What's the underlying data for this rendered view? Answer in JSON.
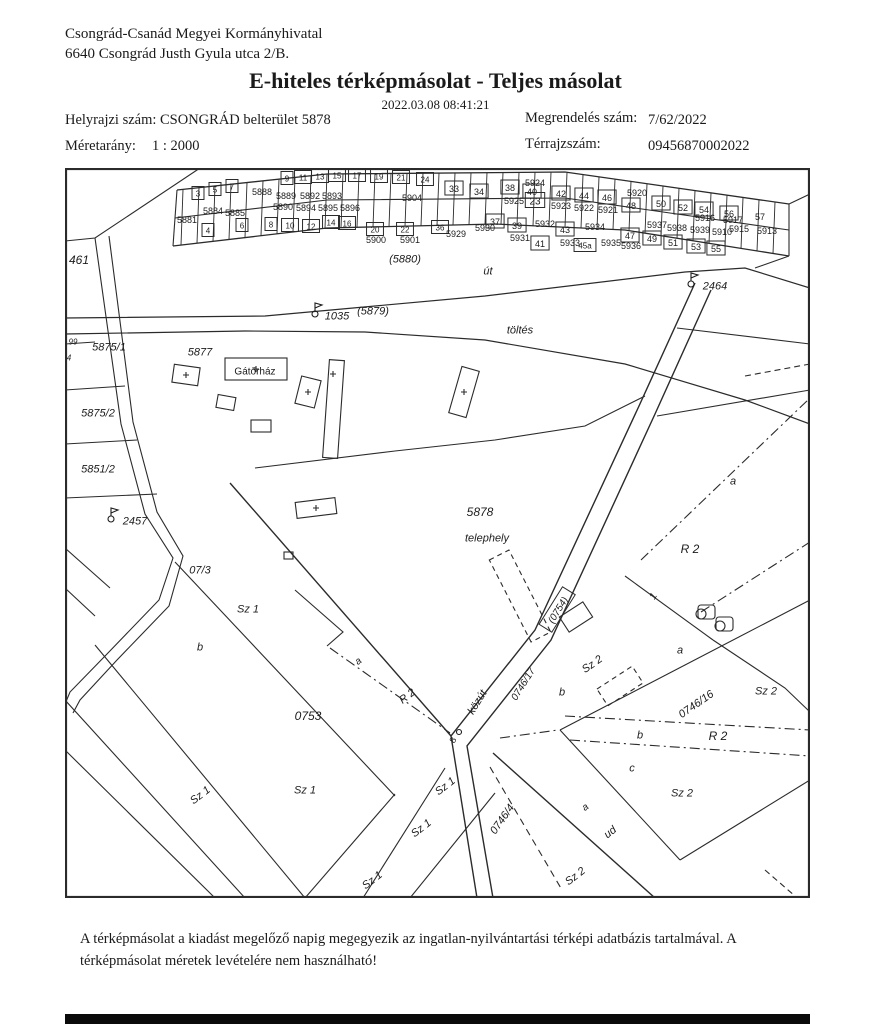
{
  "header": {
    "office_name": "Csongrád-Csanád Megyei Kormányhivatal",
    "office_address": "6640 Csongrád Justh Gyula utca 2/B.",
    "title": "E-hiteles térképmásolat - Teljes másolat",
    "timestamp": "2022.03.08 08:41:21",
    "fields": {
      "helyrajzi_label": "Helyrajzi szám:",
      "helyrajzi_value": "CSONGRÁD belterület 5878",
      "megrendeles_label": "Megrendelés szám:",
      "megrendeles_value": "7/62/2022",
      "meretarany_label": "Méretarány:",
      "meretarany_value": "1 : 2000",
      "terrajz_label": "Térrajzszám:",
      "terrajz_value": "09456870002022"
    }
  },
  "footer": {
    "disclaimer": "A térképmásolat a kiadást megelőző napig megegyezik az ingatlan-nyilvántartási térképi adatbázis tartalmával. A térképmásolat méretek levételére nem használható!"
  },
  "map": {
    "labels": [
      {
        "t": "461",
        "x": 14,
        "y": 92,
        "r": 0,
        "s": 12,
        "k": "i"
      },
      {
        "t": "(5880)",
        "x": 340,
        "y": 91,
        "r": 0,
        "s": 11,
        "k": "i"
      },
      {
        "t": "út",
        "x": 423,
        "y": 103,
        "r": 0,
        "s": 11,
        "k": "i"
      },
      {
        "t": "1035",
        "x": 272,
        "y": 148,
        "r": 0,
        "s": 11,
        "k": "i"
      },
      {
        "t": "(5879)",
        "x": 308,
        "y": 143,
        "r": 0,
        "s": 11,
        "k": "i"
      },
      {
        "t": "töltés",
        "x": 455,
        "y": 162,
        "r": 0,
        "s": 11,
        "k": "i"
      },
      {
        "t": "2464",
        "x": 650,
        "y": 118,
        "r": 0,
        "s": 11,
        "k": "i"
      },
      {
        "t": "99",
        "x": 8,
        "y": 174,
        "r": 0,
        "s": 8,
        "k": "i"
      },
      {
        "t": "5875/1",
        "x": 44,
        "y": 179,
        "r": 0,
        "s": 11,
        "k": "i"
      },
      {
        "t": "4",
        "x": 4,
        "y": 190,
        "r": 0,
        "s": 8,
        "k": "i"
      },
      {
        "t": "5877",
        "x": 135,
        "y": 184,
        "r": 0,
        "s": 11,
        "k": "i"
      },
      {
        "t": "Gátőrház",
        "x": 190,
        "y": 203,
        "r": 0,
        "s": 10,
        "k": "n"
      },
      {
        "t": "5875/2",
        "x": 33,
        "y": 245,
        "r": 0,
        "s": 11,
        "k": "i"
      },
      {
        "t": "5851/2",
        "x": 33,
        "y": 301,
        "r": 0,
        "s": 11,
        "k": "i"
      },
      {
        "t": "2457",
        "x": 70,
        "y": 353,
        "r": 0,
        "s": 11,
        "k": "i"
      },
      {
        "t": "07/3",
        "x": 135,
        "y": 402,
        "r": 0,
        "s": 11,
        "k": "i"
      },
      {
        "t": "Sz 1",
        "x": 183,
        "y": 441,
        "r": 0,
        "s": 11,
        "k": "i"
      },
      {
        "t": "b",
        "x": 135,
        "y": 479,
        "r": 0,
        "s": 11,
        "k": "i"
      },
      {
        "t": "0753",
        "x": 243,
        "y": 548,
        "r": 0,
        "s": 12,
        "k": "i"
      },
      {
        "t": "Sz 1",
        "x": 240,
        "y": 622,
        "r": 0,
        "s": 11,
        "k": "i"
      },
      {
        "t": "Sz 1",
        "x": 135,
        "y": 627,
        "r": -38,
        "s": 11,
        "k": "i"
      },
      {
        "t": "a",
        "x": 293,
        "y": 493,
        "r": -38,
        "s": 10,
        "k": "i"
      },
      {
        "t": "R 2",
        "x": 342,
        "y": 528,
        "r": -38,
        "s": 11,
        "k": "i"
      },
      {
        "t": "közút",
        "x": 412,
        "y": 534,
        "r": -58,
        "s": 11,
        "k": "i"
      },
      {
        "t": "8",
        "x": 388,
        "y": 572,
        "r": -58,
        "s": 9,
        "k": "n"
      },
      {
        "t": "(0754)",
        "x": 493,
        "y": 442,
        "r": -58,
        "s": 10,
        "k": "bi"
      },
      {
        "t": "0746/17",
        "x": 458,
        "y": 516,
        "r": -58,
        "s": 10,
        "k": "i"
      },
      {
        "t": "5878",
        "x": 415,
        "y": 344,
        "r": 0,
        "s": 12,
        "k": "i"
      },
      {
        "t": "telephely",
        "x": 422,
        "y": 370,
        "r": 0,
        "s": 11,
        "k": "i"
      },
      {
        "t": "R 2",
        "x": 625,
        "y": 381,
        "r": 0,
        "s": 12,
        "k": "i"
      },
      {
        "t": "a",
        "x": 668,
        "y": 313,
        "r": 0,
        "s": 11,
        "k": "i"
      },
      {
        "t": "1",
        "x": 588,
        "y": 428,
        "r": -58,
        "s": 10,
        "k": "i"
      },
      {
        "t": "Sz 2",
        "x": 527,
        "y": 496,
        "r": -35,
        "s": 11,
        "k": "i"
      },
      {
        "t": "b",
        "x": 497,
        "y": 524,
        "r": 0,
        "s": 11,
        "k": "i"
      },
      {
        "t": "a",
        "x": 615,
        "y": 482,
        "r": 0,
        "s": 11,
        "k": "i"
      },
      {
        "t": "0746/16",
        "x": 631,
        "y": 536,
        "r": -35,
        "s": 11,
        "k": "i"
      },
      {
        "t": "Sz 2",
        "x": 701,
        "y": 523,
        "r": 0,
        "s": 11,
        "k": "i"
      },
      {
        "t": "b",
        "x": 575,
        "y": 567,
        "r": 0,
        "s": 11,
        "k": "i"
      },
      {
        "t": "R 2",
        "x": 653,
        "y": 568,
        "r": 0,
        "s": 12,
        "k": "i"
      },
      {
        "t": "c",
        "x": 567,
        "y": 600,
        "r": 0,
        "s": 11,
        "k": "i"
      },
      {
        "t": "Sz 2",
        "x": 617,
        "y": 625,
        "r": 0,
        "s": 11,
        "k": "i"
      },
      {
        "t": "a",
        "x": 520,
        "y": 639,
        "r": -38,
        "s": 10,
        "k": "i"
      },
      {
        "t": "ud",
        "x": 545,
        "y": 664,
        "r": -38,
        "s": 11,
        "k": "i"
      },
      {
        "t": "Sz 1",
        "x": 380,
        "y": 618,
        "r": -38,
        "s": 11,
        "k": "i"
      },
      {
        "t": "Sz 1",
        "x": 356,
        "y": 660,
        "r": -38,
        "s": 11,
        "k": "i"
      },
      {
        "t": "Sz 1",
        "x": 307,
        "y": 712,
        "r": -38,
        "s": 11,
        "k": "i"
      },
      {
        "t": "0746/4",
        "x": 437,
        "y": 651,
        "r": -55,
        "s": 11,
        "k": "i"
      },
      {
        "t": "Sz 2",
        "x": 510,
        "y": 708,
        "r": -38,
        "s": 11,
        "k": "i"
      },
      {
        "t": "5888",
        "x": 197,
        "y": 24,
        "r": 0,
        "s": 9,
        "k": "n"
      },
      {
        "t": "5889",
        "x": 221,
        "y": 28,
        "r": 0,
        "s": 9,
        "k": "n"
      },
      {
        "t": "5892",
        "x": 245,
        "y": 28,
        "r": 0,
        "s": 9,
        "k": "n"
      },
      {
        "t": "5893",
        "x": 267,
        "y": 28,
        "r": 0,
        "s": 9,
        "k": "n"
      },
      {
        "t": "5904",
        "x": 347,
        "y": 30,
        "r": 0,
        "s": 9,
        "k": "n"
      },
      {
        "t": "5890",
        "x": 218,
        "y": 39,
        "r": 0,
        "s": 9,
        "k": "n"
      },
      {
        "t": "5894",
        "x": 241,
        "y": 40,
        "r": 0,
        "s": 9,
        "k": "n"
      },
      {
        "t": "5895",
        "x": 263,
        "y": 40,
        "r": 0,
        "s": 9,
        "k": "n"
      },
      {
        "t": "5896",
        "x": 285,
        "y": 40,
        "r": 0,
        "s": 9,
        "k": "n"
      },
      {
        "t": "3",
        "x": 133,
        "y": 26,
        "r": 0,
        "s": 8,
        "k": "b"
      },
      {
        "t": "5",
        "x": 150,
        "y": 22,
        "r": 0,
        "s": 8,
        "k": "b"
      },
      {
        "t": "7",
        "x": 167,
        "y": 19,
        "r": 0,
        "s": 8,
        "k": "b"
      },
      {
        "t": "9",
        "x": 222,
        "y": 11,
        "r": 0,
        "s": 8,
        "k": "b"
      },
      {
        "t": "11",
        "x": 238,
        "y": 10,
        "r": 0,
        "s": 8,
        "k": "b"
      },
      {
        "t": "13",
        "x": 255,
        "y": 9,
        "r": 0,
        "s": 8,
        "k": "b"
      },
      {
        "t": "15",
        "x": 272,
        "y": 8,
        "r": 0,
        "s": 8,
        "k": "b"
      },
      {
        "t": "17",
        "x": 292,
        "y": 8,
        "r": 0,
        "s": 8,
        "k": "b"
      },
      {
        "t": "19",
        "x": 314,
        "y": 9,
        "r": 0,
        "s": 8,
        "k": "b"
      },
      {
        "t": "21",
        "x": 336,
        "y": 10,
        "r": 0,
        "s": 8,
        "k": "b"
      },
      {
        "t": "24",
        "x": 360,
        "y": 12,
        "r": 0,
        "s": 8,
        "k": "b"
      },
      {
        "t": "23",
        "x": 470,
        "y": 33,
        "r": 0,
        "s": 10,
        "k": "b"
      },
      {
        "t": "33",
        "x": 389,
        "y": 21,
        "r": 0,
        "s": 9,
        "k": "b"
      },
      {
        "t": "34",
        "x": 414,
        "y": 24,
        "r": 0,
        "s": 9,
        "k": "b"
      },
      {
        "t": "38",
        "x": 445,
        "y": 20,
        "r": 0,
        "s": 9,
        "k": "b"
      },
      {
        "t": "5925",
        "x": 449,
        "y": 33,
        "r": 0,
        "s": 9,
        "k": "n"
      },
      {
        "t": "5924",
        "x": 470,
        "y": 15,
        "r": 0,
        "s": 9,
        "k": "n"
      },
      {
        "t": "40",
        "x": 467,
        "y": 24,
        "r": 0,
        "s": 9,
        "k": "b"
      },
      {
        "t": "42",
        "x": 496,
        "y": 26,
        "r": 0,
        "s": 9,
        "k": "b"
      },
      {
        "t": "5923",
        "x": 496,
        "y": 38,
        "r": 0,
        "s": 9,
        "k": "n"
      },
      {
        "t": "44",
        "x": 519,
        "y": 28,
        "r": 0,
        "s": 9,
        "k": "b"
      },
      {
        "t": "5922",
        "x": 519,
        "y": 40,
        "r": 0,
        "s": 9,
        "k": "n"
      },
      {
        "t": "46",
        "x": 542,
        "y": 30,
        "r": 0,
        "s": 9,
        "k": "b"
      },
      {
        "t": "5921",
        "x": 543,
        "y": 42,
        "r": 0,
        "s": 9,
        "k": "n"
      },
      {
        "t": "5920",
        "x": 572,
        "y": 25,
        "r": 0,
        "s": 9,
        "k": "n"
      },
      {
        "t": "48",
        "x": 566,
        "y": 38,
        "r": 0,
        "s": 9,
        "k": "b"
      },
      {
        "t": "50",
        "x": 596,
        "y": 36,
        "r": 0,
        "s": 9,
        "k": "b"
      },
      {
        "t": "5916",
        "x": 640,
        "y": 50,
        "r": 0,
        "s": 9,
        "k": "n"
      },
      {
        "t": "5917",
        "x": 668,
        "y": 52,
        "r": 0,
        "s": 9,
        "k": "n"
      },
      {
        "t": "52",
        "x": 618,
        "y": 40,
        "r": 0,
        "s": 9,
        "k": "b"
      },
      {
        "t": "54",
        "x": 639,
        "y": 42,
        "r": 0,
        "s": 9,
        "k": "b"
      },
      {
        "t": "56",
        "x": 664,
        "y": 46,
        "r": 0,
        "s": 9,
        "k": "b"
      },
      {
        "t": "57",
        "x": 695,
        "y": 49,
        "r": 0,
        "s": 9,
        "k": "n"
      },
      {
        "t": "5915",
        "x": 674,
        "y": 61,
        "r": 0,
        "s": 9,
        "k": "n"
      },
      {
        "t": "5913",
        "x": 702,
        "y": 63,
        "r": 0,
        "s": 9,
        "k": "n"
      },
      {
        "t": "5937",
        "x": 592,
        "y": 57,
        "r": 0,
        "s": 9,
        "k": "n"
      },
      {
        "t": "5938",
        "x": 612,
        "y": 60,
        "r": 0,
        "s": 9,
        "k": "n"
      },
      {
        "t": "5939",
        "x": 635,
        "y": 62,
        "r": 0,
        "s": 9,
        "k": "n"
      },
      {
        "t": "5910",
        "x": 657,
        "y": 64,
        "r": 0,
        "s": 9,
        "k": "n"
      },
      {
        "t": "47",
        "x": 565,
        "y": 68,
        "r": 0,
        "s": 9,
        "k": "b"
      },
      {
        "t": "49",
        "x": 587,
        "y": 71,
        "r": 0,
        "s": 9,
        "k": "b"
      },
      {
        "t": "51",
        "x": 608,
        "y": 75,
        "r": 0,
        "s": 9,
        "k": "b"
      },
      {
        "t": "53",
        "x": 631,
        "y": 79,
        "r": 0,
        "s": 9,
        "k": "b"
      },
      {
        "t": "55",
        "x": 651,
        "y": 81,
        "r": 0,
        "s": 9,
        "k": "b"
      },
      {
        "t": "5881",
        "x": 122,
        "y": 52,
        "r": 0,
        "s": 9,
        "k": "n"
      },
      {
        "t": "4",
        "x": 143,
        "y": 63,
        "r": 0,
        "s": 8,
        "k": "b"
      },
      {
        "t": "5884",
        "x": 148,
        "y": 43,
        "r": 0,
        "s": 9,
        "k": "n"
      },
      {
        "t": "5885",
        "x": 170,
        "y": 45,
        "r": 0,
        "s": 9,
        "k": "n"
      },
      {
        "t": "6",
        "x": 177,
        "y": 58,
        "r": 0,
        "s": 8,
        "k": "b"
      },
      {
        "t": "8",
        "x": 206,
        "y": 57,
        "r": 0,
        "s": 8,
        "k": "b"
      },
      {
        "t": "10",
        "x": 225,
        "y": 58,
        "r": 0,
        "s": 8,
        "k": "b"
      },
      {
        "t": "12",
        "x": 246,
        "y": 59,
        "r": 0,
        "s": 8,
        "k": "b"
      },
      {
        "t": "14",
        "x": 266,
        "y": 55,
        "r": 0,
        "s": 8,
        "k": "b"
      },
      {
        "t": "16",
        "x": 282,
        "y": 56,
        "r": 0,
        "s": 8,
        "k": "b"
      },
      {
        "t": "20",
        "x": 310,
        "y": 62,
        "r": 0,
        "s": 8,
        "k": "b"
      },
      {
        "t": "5900",
        "x": 311,
        "y": 72,
        "r": 0,
        "s": 9,
        "k": "n"
      },
      {
        "t": "22",
        "x": 340,
        "y": 62,
        "r": 0,
        "s": 8,
        "k": "b"
      },
      {
        "t": "5901",
        "x": 345,
        "y": 72,
        "r": 0,
        "s": 9,
        "k": "n"
      },
      {
        "t": "36",
        "x": 375,
        "y": 60,
        "r": 0,
        "s": 8,
        "k": "b"
      },
      {
        "t": "5929",
        "x": 391,
        "y": 66,
        "r": 0,
        "s": 9,
        "k": "n"
      },
      {
        "t": "5930",
        "x": 420,
        "y": 60,
        "r": 0,
        "s": 9,
        "k": "n"
      },
      {
        "t": "37",
        "x": 430,
        "y": 54,
        "r": 0,
        "s": 9,
        "k": "b"
      },
      {
        "t": "39",
        "x": 452,
        "y": 58,
        "r": 0,
        "s": 9,
        "k": "b"
      },
      {
        "t": "5931",
        "x": 455,
        "y": 70,
        "r": 0,
        "s": 9,
        "k": "n"
      },
      {
        "t": "41",
        "x": 475,
        "y": 76,
        "r": 0,
        "s": 9,
        "k": "b"
      },
      {
        "t": "5932",
        "x": 480,
        "y": 56,
        "r": 0,
        "s": 9,
        "k": "n"
      },
      {
        "t": "43",
        "x": 500,
        "y": 62,
        "r": 0,
        "s": 9,
        "k": "b"
      },
      {
        "t": "5933",
        "x": 505,
        "y": 75,
        "r": 0,
        "s": 9,
        "k": "n"
      },
      {
        "t": "5934",
        "x": 530,
        "y": 59,
        "r": 0,
        "s": 9,
        "k": "n"
      },
      {
        "t": "45a",
        "x": 520,
        "y": 78,
        "r": 0,
        "s": 8,
        "k": "b"
      },
      {
        "t": "5935",
        "x": 546,
        "y": 75,
        "r": 0,
        "s": 9,
        "k": "n"
      },
      {
        "t": "5936",
        "x": 566,
        "y": 78,
        "r": 0,
        "s": 9,
        "k": "n"
      }
    ]
  }
}
